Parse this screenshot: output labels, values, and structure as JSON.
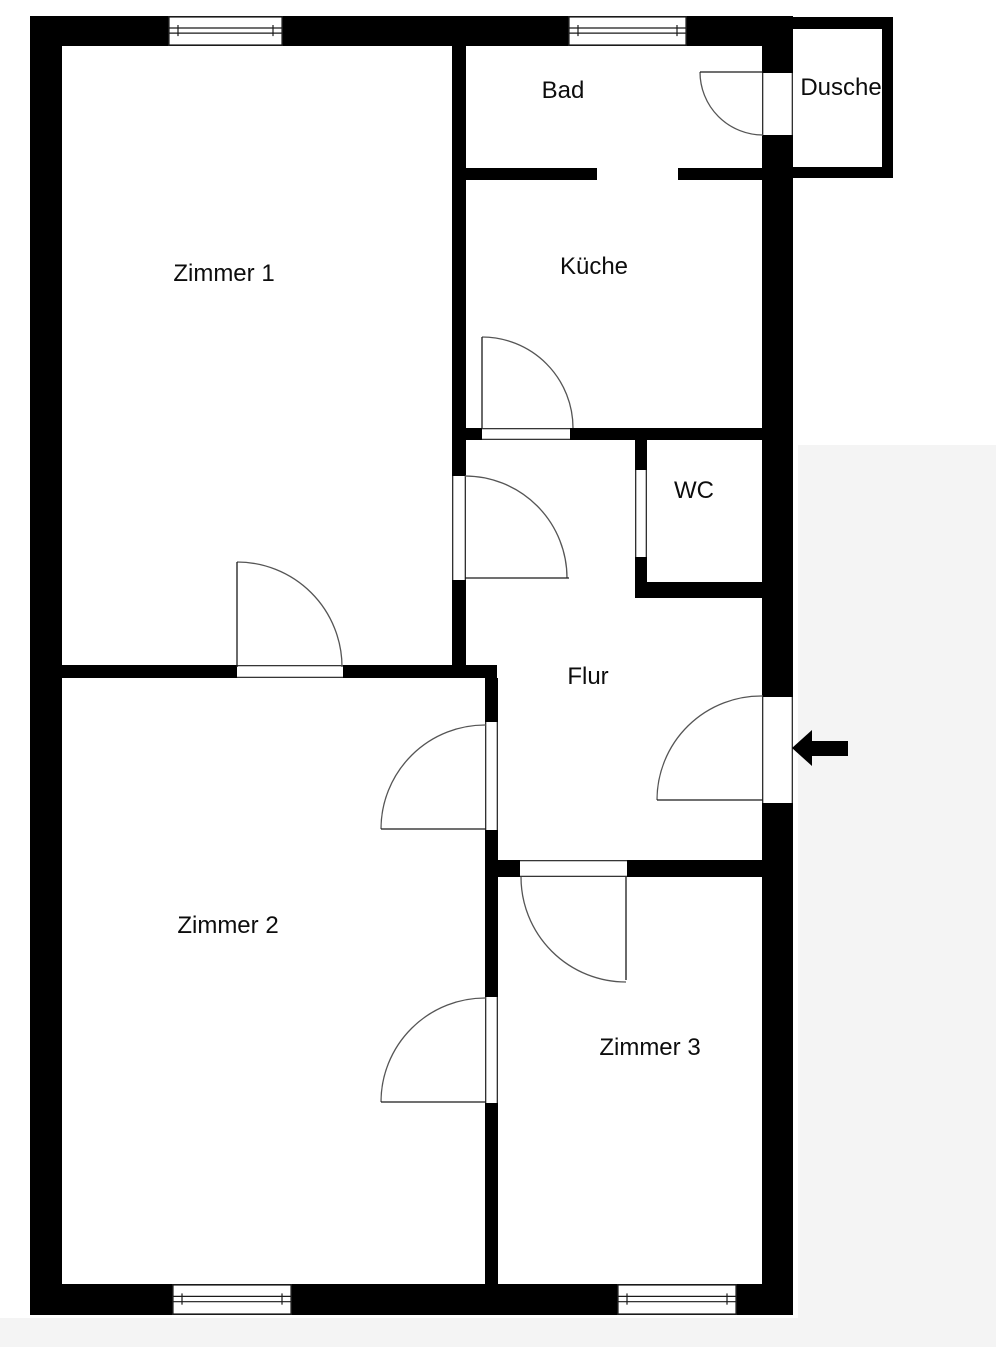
{
  "colors": {
    "wall": "#000000",
    "background": "#ffffff",
    "thin_line": "#1a1a1a",
    "arc_line": "#555555",
    "label_text": "#0d0d0d",
    "outside_shade": "#f4f4f4"
  },
  "rooms": [
    {
      "name": "zimmer-1",
      "label": "Zimmer 1",
      "x": 224,
      "y": 274
    },
    {
      "name": "bad",
      "label": "Bad",
      "x": 563,
      "y": 91
    },
    {
      "name": "dusche",
      "label": "Dusche",
      "x": 841,
      "y": 88
    },
    {
      "name": "kueche",
      "label": "Küche",
      "x": 594,
      "y": 267
    },
    {
      "name": "wc",
      "label": "WC",
      "x": 694,
      "y": 491
    },
    {
      "name": "flur",
      "label": "Flur",
      "x": 588,
      "y": 677
    },
    {
      "name": "zimmer-2",
      "label": "Zimmer 2",
      "x": 228,
      "y": 926
    },
    {
      "name": "zimmer-3",
      "label": "Zimmer 3",
      "x": 650,
      "y": 1048
    }
  ],
  "plan": {
    "width": 996,
    "height": 1347,
    "shades": [
      {
        "x": 798,
        "y": 445,
        "w": 198,
        "h": 902
      },
      {
        "x": 0,
        "y": 1318,
        "w": 996,
        "h": 29
      }
    ],
    "walls": [
      {
        "x": 30,
        "y": 16,
        "w": 138,
        "h": 30
      },
      {
        "x": 283,
        "y": 16,
        "w": 285,
        "h": 30
      },
      {
        "x": 687,
        "y": 16,
        "w": 106,
        "h": 30
      },
      {
        "x": 30,
        "y": 16,
        "w": 32,
        "h": 1299
      },
      {
        "x": 30,
        "y": 1284,
        "w": 142,
        "h": 31
      },
      {
        "x": 292,
        "y": 1284,
        "w": 325,
        "h": 31
      },
      {
        "x": 737,
        "y": 1284,
        "w": 56,
        "h": 31
      },
      {
        "x": 762,
        "y": 16,
        "w": 31,
        "h": 57
      },
      {
        "x": 762,
        "y": 135,
        "w": 31,
        "h": 562
      },
      {
        "x": 762,
        "y": 803,
        "w": 31,
        "h": 512
      },
      {
        "x": 793,
        "y": 17,
        "w": 100,
        "h": 12
      },
      {
        "x": 882,
        "y": 29,
        "w": 11,
        "h": 149
      },
      {
        "x": 793,
        "y": 167,
        "w": 100,
        "h": 11
      },
      {
        "x": 452,
        "y": 46,
        "w": 14,
        "h": 394
      },
      {
        "x": 452,
        "y": 428,
        "w": 30,
        "h": 12
      },
      {
        "x": 570,
        "y": 428,
        "w": 192,
        "h": 12
      },
      {
        "x": 452,
        "y": 440,
        "w": 14,
        "h": 36
      },
      {
        "x": 452,
        "y": 580,
        "w": 14,
        "h": 98
      },
      {
        "x": 62,
        "y": 665,
        "w": 175,
        "h": 13
      },
      {
        "x": 343,
        "y": 665,
        "w": 154,
        "h": 13
      },
      {
        "x": 485,
        "y": 678,
        "w": 13,
        "h": 44
      },
      {
        "x": 485,
        "y": 830,
        "w": 13,
        "h": 167
      },
      {
        "x": 485,
        "y": 1103,
        "w": 13,
        "h": 181
      },
      {
        "x": 466,
        "y": 168,
        "w": 131,
        "h": 12
      },
      {
        "x": 678,
        "y": 168,
        "w": 84,
        "h": 12
      },
      {
        "x": 635,
        "y": 440,
        "w": 12,
        "h": 30
      },
      {
        "x": 635,
        "y": 557,
        "w": 12,
        "h": 41
      },
      {
        "x": 635,
        "y": 582,
        "w": 127,
        "h": 16
      },
      {
        "x": 493,
        "y": 860,
        "w": 27,
        "h": 17
      },
      {
        "x": 627,
        "y": 860,
        "w": 135,
        "h": 17
      }
    ],
    "windows": [
      {
        "x": 168,
        "y": 16,
        "w": 115,
        "h": 30
      },
      {
        "x": 568,
        "y": 16,
        "w": 119,
        "h": 30
      },
      {
        "x": 172,
        "y": 1284,
        "w": 120,
        "h": 31
      },
      {
        "x": 617,
        "y": 1284,
        "w": 120,
        "h": 31
      }
    ],
    "door_frames": [
      {
        "x": 452,
        "y": 476,
        "w": 14,
        "h": 104,
        "o": "v"
      },
      {
        "x": 482,
        "y": 428,
        "w": 88,
        "h": 12,
        "o": "h"
      },
      {
        "x": 635,
        "y": 470,
        "w": 12,
        "h": 87,
        "o": "v"
      },
      {
        "x": 485,
        "y": 722,
        "w": 13,
        "h": 108,
        "o": "v"
      },
      {
        "x": 485,
        "y": 997,
        "w": 13,
        "h": 106,
        "o": "v"
      },
      {
        "x": 520,
        "y": 860,
        "w": 107,
        "h": 17,
        "o": "h"
      },
      {
        "x": 762,
        "y": 697,
        "w": 31,
        "h": 106,
        "o": "v"
      },
      {
        "x": 237,
        "y": 665,
        "w": 106,
        "h": 13,
        "o": "h"
      },
      {
        "x": 762,
        "y": 73,
        "w": 31,
        "h": 62,
        "o": "v"
      }
    ],
    "door_leaves": [
      {
        "x1": 465,
        "y1": 578,
        "x2": 569,
        "y2": 578
      },
      {
        "x1": 482,
        "y1": 337,
        "x2": 482,
        "y2": 428
      },
      {
        "x1": 700,
        "y1": 72,
        "x2": 763,
        "y2": 72
      },
      {
        "x1": 657,
        "y1": 800,
        "x2": 763,
        "y2": 800
      },
      {
        "x1": 381,
        "y1": 829,
        "x2": 486,
        "y2": 829
      },
      {
        "x1": 381,
        "y1": 1102,
        "x2": 486,
        "y2": 1102
      },
      {
        "x1": 626,
        "y1": 877,
        "x2": 626,
        "y2": 980
      },
      {
        "x1": 237,
        "y1": 562,
        "x2": 237,
        "y2": 667
      }
    ],
    "door_arcs": [
      {
        "d": "M465,476 A102,102 0 0 1 567,578"
      },
      {
        "d": "M482,337 A91,91 0 0 1 573,428"
      },
      {
        "d": "M700,72 A63,63 0 0 0 763,135"
      },
      {
        "d": "M657,800 A104,104 0 0 1 763,696"
      },
      {
        "d": "M486,725 A104,104 0 0 0 381,829"
      },
      {
        "d": "M486,998 A104,104 0 0 0 381,1102"
      },
      {
        "d": "M521,877 A105,105 0 0 0 626,982"
      },
      {
        "d": "M237,562 A105,105 0 0 1 342,667"
      }
    ],
    "entrance_arrow": {
      "points": "792,748 812,730 812,741 848,741 848,756 812,756 812,766"
    }
  }
}
